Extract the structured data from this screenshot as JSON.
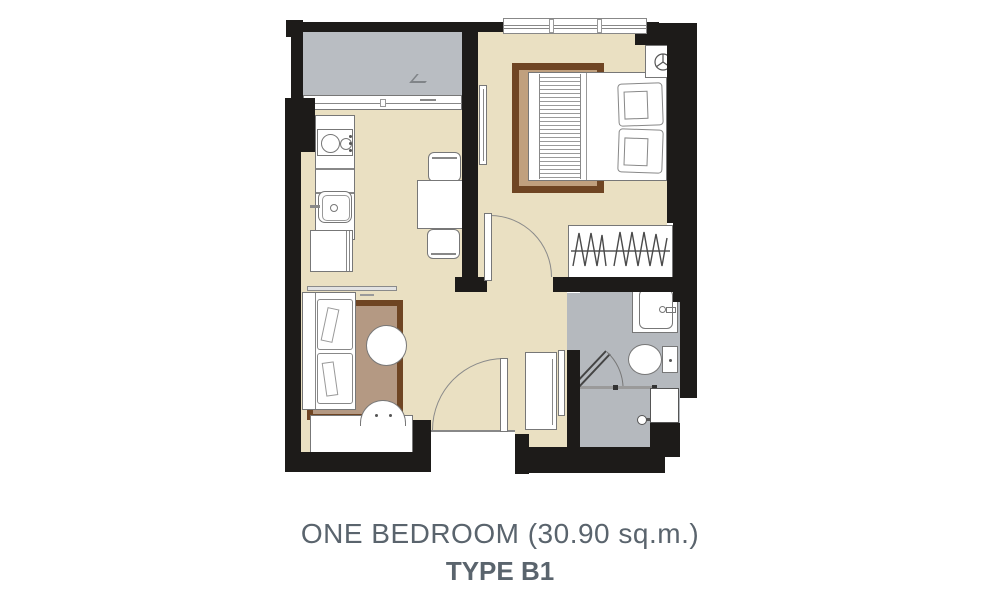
{
  "caption": {
    "title": "ONE BEDROOM (30.90 sq.m.)",
    "type": "TYPE B1"
  },
  "colors": {
    "wall": "#1d1b19",
    "floor": "#eae0c2",
    "balcony": "#b9bdc2",
    "bath": "#b5b9be",
    "rug_border": "#6f4523",
    "rug_living": "#b49983",
    "rug_bedroom": "#c0a07e",
    "outline": "#777777",
    "text": "#5a646d"
  },
  "icons": {
    "ac_fan_icon": "circle with Y fan symbol",
    "zigzag": "hanging clothes symbol",
    "drain": "balcony drain mark"
  }
}
